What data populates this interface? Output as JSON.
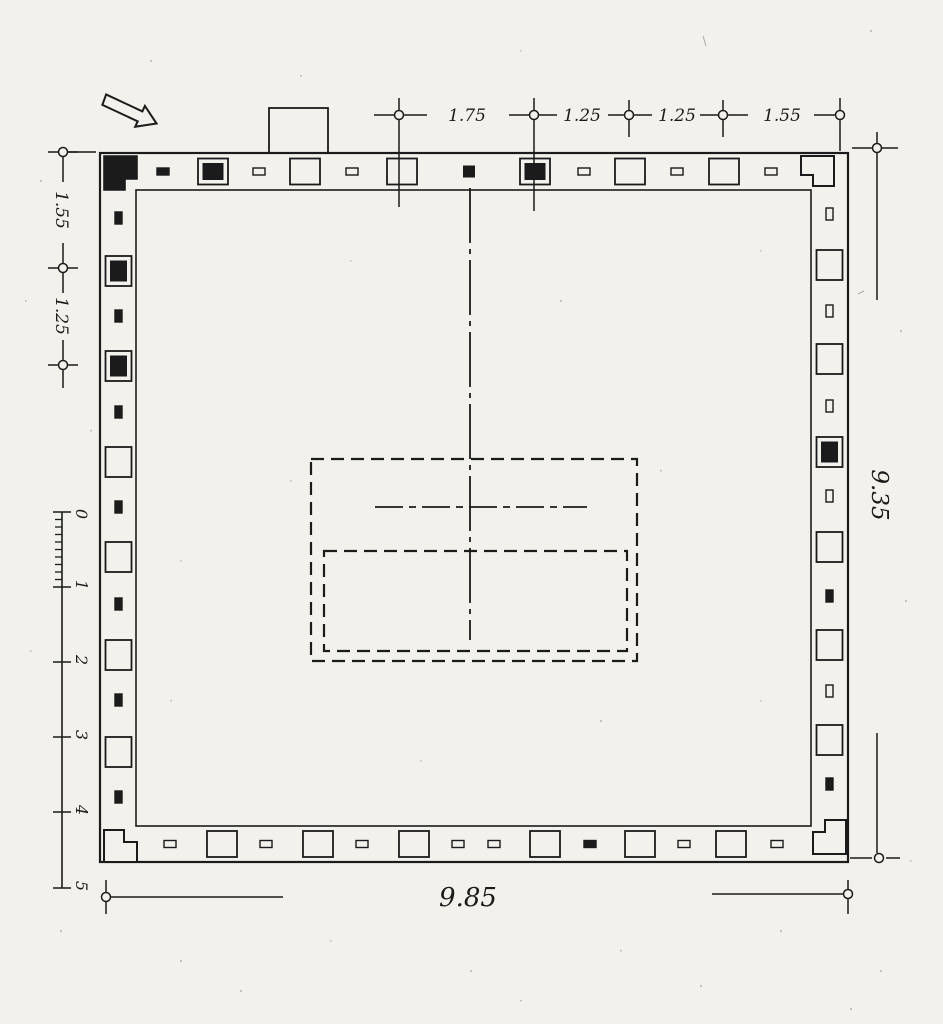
{
  "drawing": {
    "kind": "square building floor plan with colonnade walls",
    "north_arrow": "arrow-pointing-southeast"
  },
  "colors": {
    "paper": "#f2f1ec",
    "ink": "#1b1b1b"
  },
  "dimensions": {
    "top": [
      "1.75",
      "1.25",
      "1.25",
      "1.55"
    ],
    "left": [
      "1.55",
      "1.25"
    ],
    "right": "9.35",
    "bottom": "9.85"
  },
  "scale_bar": {
    "labels": [
      "0",
      "1",
      "2",
      "3",
      "4",
      "5"
    ]
  },
  "plan": {
    "walls": {
      "top": {
        "axis": "h",
        "center": 171.5,
        "items": [
          {
            "pos": 163,
            "kind": "dash_filled"
          },
          {
            "pos": 213,
            "kind": "column_filled"
          },
          {
            "pos": 259,
            "kind": "dash_open"
          },
          {
            "pos": 305,
            "kind": "column_open"
          },
          {
            "pos": 352,
            "kind": "dash_open"
          },
          {
            "pos": 402,
            "kind": "column_open"
          },
          {
            "pos": 469,
            "kind": "mark_filled"
          },
          {
            "pos": 535,
            "kind": "column_filled"
          },
          {
            "pos": 584,
            "kind": "dash_open"
          },
          {
            "pos": 630,
            "kind": "column_open"
          },
          {
            "pos": 677,
            "kind": "dash_open"
          },
          {
            "pos": 724,
            "kind": "column_open"
          },
          {
            "pos": 771,
            "kind": "dash_open"
          }
        ]
      },
      "left": {
        "axis": "v",
        "center": 118.5,
        "items": [
          {
            "pos": 218,
            "kind": "dash_filled"
          },
          {
            "pos": 271,
            "kind": "column_filled"
          },
          {
            "pos": 316,
            "kind": "dash_filled"
          },
          {
            "pos": 366,
            "kind": "column_filled"
          },
          {
            "pos": 412,
            "kind": "dash_filled"
          },
          {
            "pos": 462,
            "kind": "column_open"
          },
          {
            "pos": 507,
            "kind": "dash_filled"
          },
          {
            "pos": 557,
            "kind": "column_open"
          },
          {
            "pos": 604,
            "kind": "dash_filled"
          },
          {
            "pos": 655,
            "kind": "column_open"
          },
          {
            "pos": 700,
            "kind": "dash_filled"
          },
          {
            "pos": 752,
            "kind": "column_open"
          },
          {
            "pos": 797,
            "kind": "dash_filled"
          }
        ]
      },
      "right": {
        "axis": "v",
        "center": 829.5,
        "items": [
          {
            "pos": 214,
            "kind": "dash_open"
          },
          {
            "pos": 265,
            "kind": "column_open"
          },
          {
            "pos": 311,
            "kind": "dash_open"
          },
          {
            "pos": 359,
            "kind": "column_open"
          },
          {
            "pos": 406,
            "kind": "dash_open"
          },
          {
            "pos": 452,
            "kind": "column_filled"
          },
          {
            "pos": 496,
            "kind": "dash_open"
          },
          {
            "pos": 547,
            "kind": "column_open"
          },
          {
            "pos": 596,
            "kind": "dash_filled"
          },
          {
            "pos": 645,
            "kind": "column_open"
          },
          {
            "pos": 691,
            "kind": "dash_open"
          },
          {
            "pos": 740,
            "kind": "column_open"
          },
          {
            "pos": 784,
            "kind": "dash_filled"
          }
        ]
      },
      "bottom": {
        "axis": "h",
        "center": 844,
        "items": [
          {
            "pos": 170,
            "kind": "dash_open"
          },
          {
            "pos": 222,
            "kind": "column_open"
          },
          {
            "pos": 266,
            "kind": "dash_open"
          },
          {
            "pos": 318,
            "kind": "column_open"
          },
          {
            "pos": 362,
            "kind": "dash_open"
          },
          {
            "pos": 414,
            "kind": "column_open"
          },
          {
            "pos": 458,
            "kind": "dash_open"
          },
          {
            "pos": 494,
            "kind": "dash_open"
          },
          {
            "pos": 545,
            "kind": "column_open"
          },
          {
            "pos": 590,
            "kind": "dash_filled"
          },
          {
            "pos": 640,
            "kind": "column_open"
          },
          {
            "pos": 684,
            "kind": "dash_open"
          },
          {
            "pos": 731,
            "kind": "column_open"
          },
          {
            "pos": 777,
            "kind": "dash_open"
          }
        ]
      }
    }
  }
}
